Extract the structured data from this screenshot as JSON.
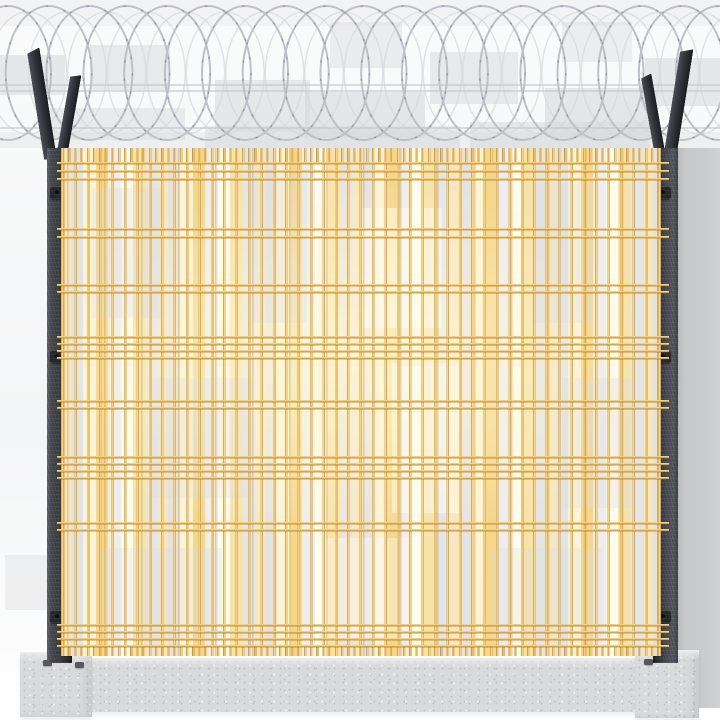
{
  "scene": {
    "description": "Product photo of an anti-climb security fence: golden-yellow welded wire mesh panel between two dark Y-top steel posts, topped by a concertina razor wire coil, standing on a speckled concrete base beam with two concrete pedestal blocks.",
    "objects": [
      "concertina-razor-wire-coil",
      "y-top-steel-post-left",
      "y-top-steel-post-right",
      "welded-mesh-fence-panel",
      "concrete-base-beam",
      "concrete-pedestal-left",
      "concrete-pedestal-right"
    ]
  },
  "colors": {
    "gold": "#E7B851",
    "goldHi": "#FBE6AC",
    "goldDeep": "#C9922F",
    "coil": "#BDC1C7",
    "coilDark": "#8E949B",
    "concrete": "#D9DADB",
    "concreteHi": "#ECEDEE",
    "concreteDot": "#C0C1C3",
    "bgWhite": "#FAFBFB",
    "patch": "#D6D8DB",
    "column": "#C9CBCD",
    "cream": "#F8E7BE",
    "slotGray": "#E2E3E5"
  },
  "razor_wire": {
    "loop_count": 19,
    "loop_spacing": 39.5,
    "first_cx": 8,
    "center_y": 73,
    "radius_x": 43,
    "radius_y": 67,
    "support_line_ys": [
      85,
      91,
      128
    ]
  },
  "posts": {
    "top_y": 148,
    "bottom_y": 663,
    "width": 25,
    "left_x": 47,
    "right_x": 653,
    "clamp_ys": [
      186,
      350,
      610
    ]
  },
  "mesh": {
    "left": 62,
    "top": 148,
    "width": 598,
    "height": 508,
    "vertical_wire_spacing": 12.4,
    "horizontal_wire_ys": [
      14,
      22,
      30,
      80,
      88,
      136,
      143,
      188,
      195,
      202,
      209,
      252,
      259,
      308,
      315,
      322,
      329,
      374,
      381,
      476,
      483,
      490,
      497
    ]
  },
  "concrete": {
    "bolts": [
      {
        "pedestal": "left",
        "x": 23,
        "y": 8
      },
      {
        "pedestal": "left",
        "x": 55,
        "y": 10
      },
      {
        "pedestal": "right",
        "x": 9,
        "y": 9
      }
    ]
  },
  "background": {
    "patches": [
      {
        "x": 0,
        "y": 0,
        "w": 720,
        "h": 26,
        "o": 0.2
      },
      {
        "x": 0,
        "y": 55,
        "w": 65,
        "h": 40,
        "o": 0.55
      },
      {
        "x": 90,
        "y": 45,
        "w": 80,
        "h": 45,
        "o": 0.5
      },
      {
        "x": 215,
        "y": 80,
        "w": 95,
        "h": 52,
        "o": 0.55
      },
      {
        "x": 330,
        "y": 22,
        "w": 72,
        "h": 46,
        "o": 0.4
      },
      {
        "x": 305,
        "y": 92,
        "w": 120,
        "h": 46,
        "o": 0.6
      },
      {
        "x": 430,
        "y": 52,
        "w": 88,
        "h": 52,
        "o": 0.5
      },
      {
        "x": 562,
        "y": 22,
        "w": 70,
        "h": 40,
        "o": 0.38
      },
      {
        "x": 545,
        "y": 88,
        "w": 110,
        "h": 50,
        "o": 0.6
      },
      {
        "x": 645,
        "y": 58,
        "w": 75,
        "h": 48,
        "o": 0.55
      },
      {
        "x": 45,
        "y": 108,
        "w": 140,
        "h": 32,
        "o": 0.45
      },
      {
        "x": 205,
        "y": 126,
        "w": 255,
        "h": 22,
        "o": 0.5
      },
      {
        "x": 470,
        "y": 122,
        "w": 180,
        "h": 26,
        "o": 0.55
      },
      {
        "x": 0,
        "y": 132,
        "w": 720,
        "h": 16,
        "o": 0.28
      },
      {
        "x": 5,
        "y": 555,
        "w": 45,
        "h": 55,
        "o": 0.35
      }
    ],
    "mesh_patches": [
      {
        "x": 30,
        "y": 40,
        "w": 70,
        "h": 130,
        "t": "g",
        "o": 0.35
      },
      {
        "x": 190,
        "y": 25,
        "w": 55,
        "h": 150,
        "t": "g",
        "o": 0.3
      },
      {
        "x": 300,
        "y": 60,
        "w": 80,
        "h": 120,
        "t": "w",
        "o": 0.5
      },
      {
        "x": 470,
        "y": 35,
        "w": 60,
        "h": 140,
        "t": "g",
        "o": 0.35
      },
      {
        "x": 90,
        "y": 230,
        "w": 100,
        "h": 120,
        "t": "g",
        "o": 0.3
      },
      {
        "x": 330,
        "y": 215,
        "w": 70,
        "h": 150,
        "t": "w",
        "o": 0.45
      },
      {
        "x": 500,
        "y": 230,
        "w": 70,
        "h": 130,
        "t": "g",
        "o": 0.35
      },
      {
        "x": 40,
        "y": 400,
        "w": 120,
        "h": 90,
        "t": "g",
        "o": 0.3
      },
      {
        "x": 260,
        "y": 390,
        "w": 90,
        "h": 100,
        "t": "w",
        "o": 0.4
      },
      {
        "x": 430,
        "y": 400,
        "w": 110,
        "h": 95,
        "t": "g",
        "o": 0.3
      }
    ]
  }
}
